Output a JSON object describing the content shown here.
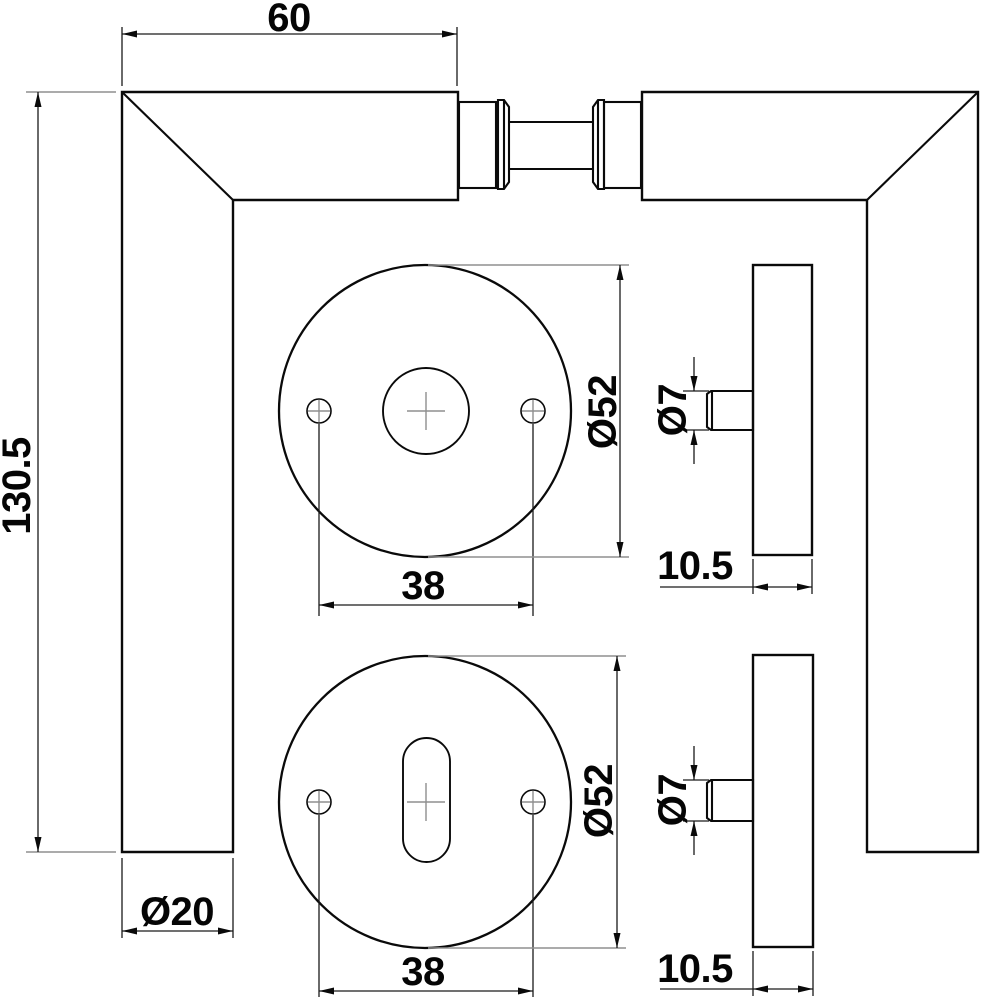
{
  "drawing_type": "door-handle-technical-drawing",
  "colors": {
    "object_line": "#0a0a0a",
    "dimension_line": "#1a1a1a",
    "centerline_gray": "#8f8f8f",
    "background": "#ffffff"
  },
  "front_view": {
    "length": "60",
    "height": "130.5",
    "grip_diameter": "Ø20"
  },
  "rose_top": {
    "diameter": "Ø52",
    "screw_spacing": "38"
  },
  "rose_bottom": {
    "diameter": "Ø52",
    "screw_spacing": "38"
  },
  "side_view_top": {
    "pin_diameter": "Ø7",
    "thickness": "10.5"
  },
  "side_view_bottom": {
    "pin_diameter": "Ø7",
    "thickness": "10.5"
  }
}
